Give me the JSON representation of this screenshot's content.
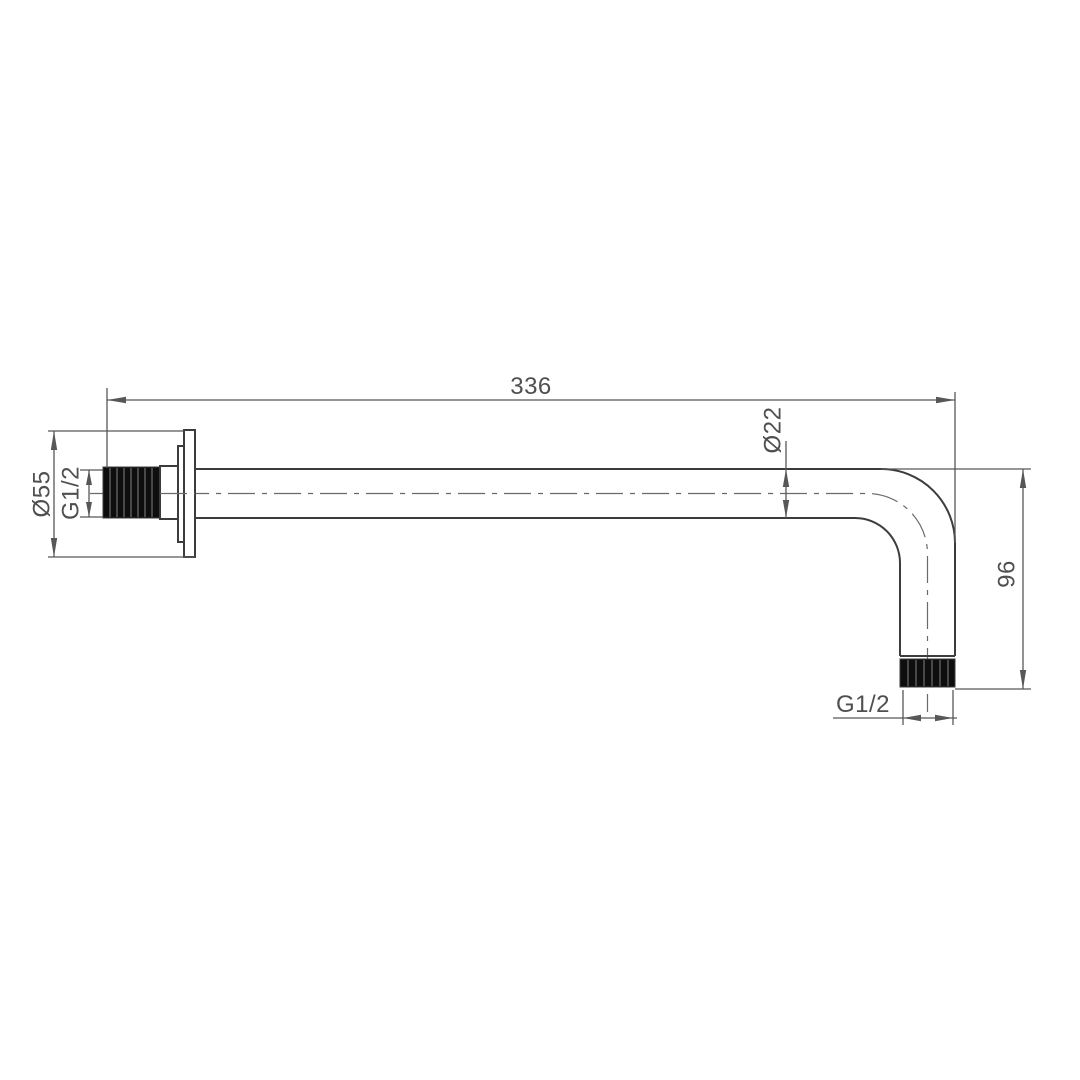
{
  "drawing": {
    "labels": {
      "overall_length": "336",
      "pipe_diameter": "Ø22",
      "flange_diameter": "Ø55",
      "inlet_thread": "G1/2",
      "drop_height": "96",
      "outlet_thread": "G1/2"
    },
    "colors": {
      "background": "#ffffff",
      "line": "#3c3c3c",
      "dimension": "#575757",
      "centerline": "#6a6a6a",
      "text": "#4f4f4f",
      "thread_fill": "#0e0e0e"
    }
  }
}
